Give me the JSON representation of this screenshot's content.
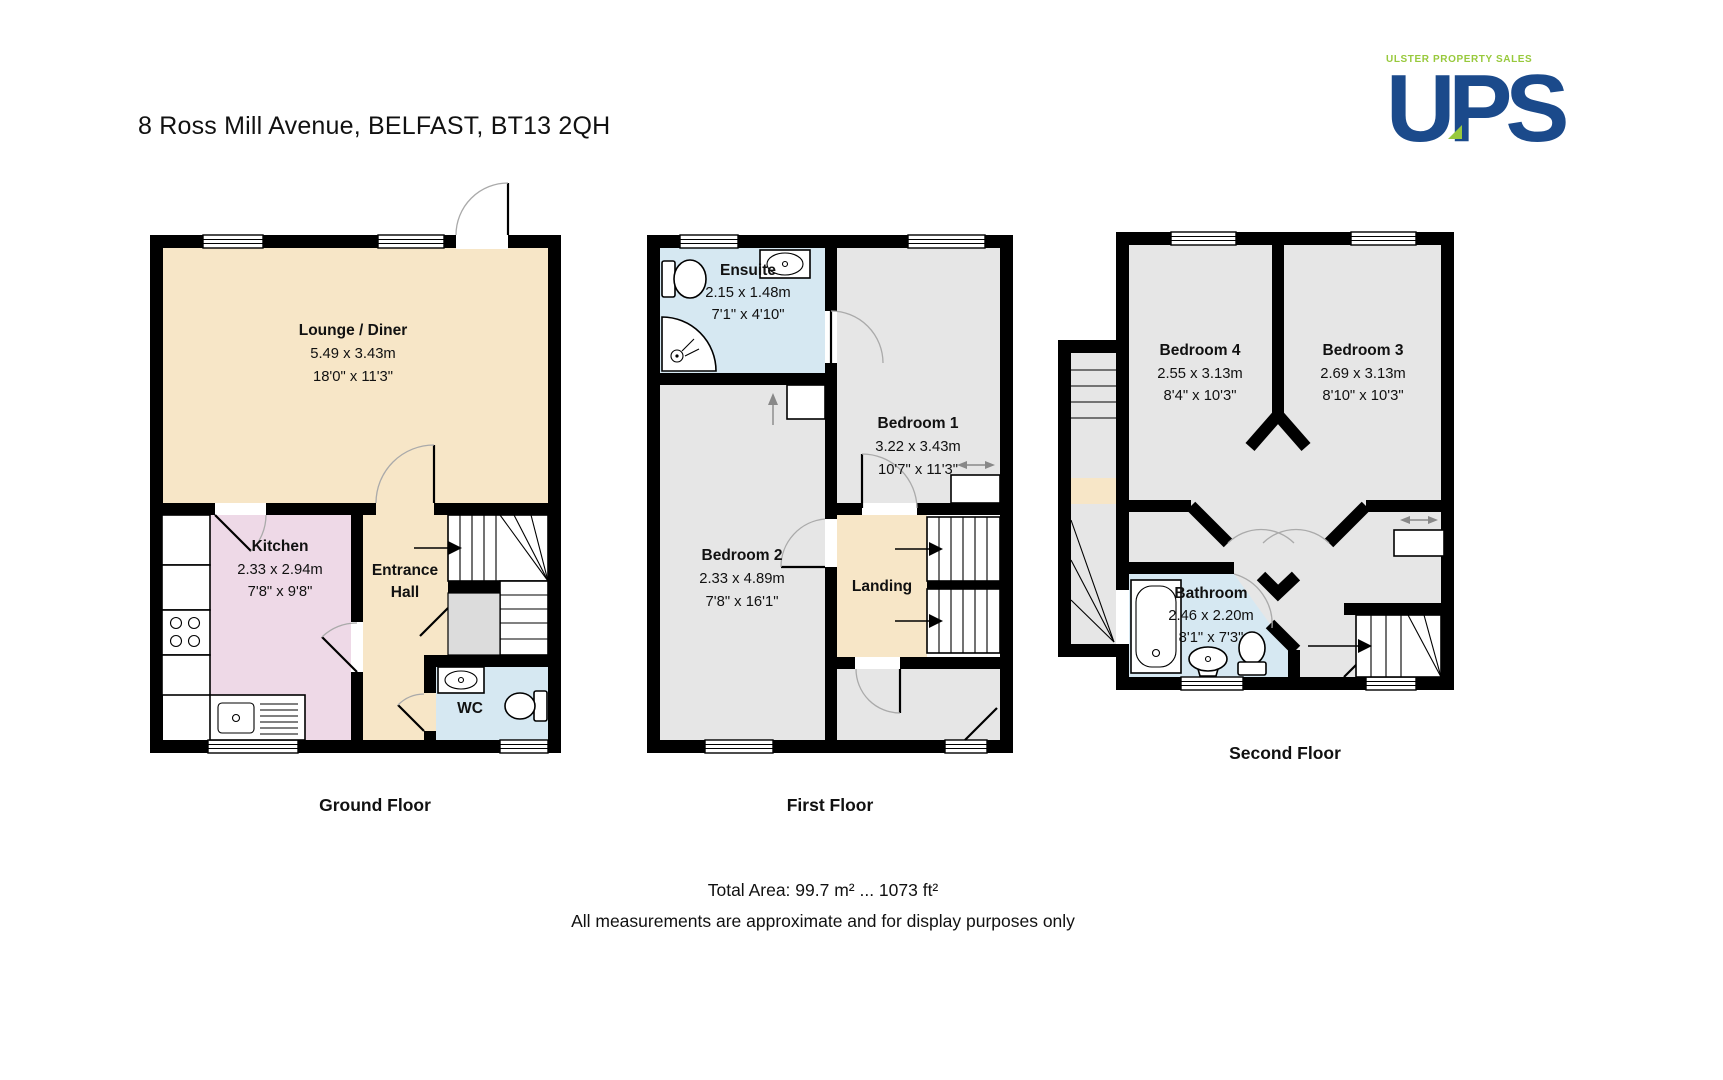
{
  "page": {
    "title": "8 Ross Mill Avenue, BELFAST, BT13 2QH",
    "total_area": "Total Area: 99.7 m² ... 1073 ft²",
    "disclaimer": "All measurements are approximate and for display purposes only"
  },
  "logo": {
    "tagline": "ULSTER PROPERTY SALES",
    "text": "UPS"
  },
  "colors": {
    "wall": "#000000",
    "lounge_hall_landing": "#f7e6c7",
    "kitchen": "#eed9e7",
    "bath_wc": "#d6e8f2",
    "bedroom_gray": "#e6e6e6",
    "cupboard_gray": "#dcdcdc",
    "logo_navy": "#1b4a8b",
    "logo_green": "#98c93c"
  },
  "floors": {
    "ground": {
      "label": "Ground Floor",
      "lounge": {
        "name": "Lounge / Diner",
        "metric": "5.49 x 3.43m",
        "imperial": "18'0\" x 11'3\""
      },
      "kitchen": {
        "name": "Kitchen",
        "metric": "2.33 x 2.94m",
        "imperial": "7'8\" x 9'8\""
      },
      "hall": {
        "line1": "Entrance",
        "line2": "Hall"
      },
      "wc": {
        "name": "WC"
      }
    },
    "first": {
      "label": "First Floor",
      "ensuite": {
        "name": "Ensuite",
        "metric": "2.15 x 1.48m",
        "imperial": "7'1\" x 4'10\""
      },
      "bedroom1": {
        "name": "Bedroom 1",
        "metric": "3.22 x 3.43m",
        "imperial": "10'7\" x 11'3\""
      },
      "bedroom2": {
        "name": "Bedroom 2",
        "metric": "2.33 x 4.89m",
        "imperial": "7'8\" x 16'1\""
      },
      "landing": {
        "name": "Landing"
      }
    },
    "second": {
      "label": "Second Floor",
      "bedroom4": {
        "name": "Bedroom 4",
        "metric": "2.55 x 3.13m",
        "imperial": "8'4\" x 10'3\""
      },
      "bedroom3": {
        "name": "Bedroom 3",
        "metric": "2.69 x 3.13m",
        "imperial": "8'10\" x 10'3\""
      },
      "bathroom": {
        "name": "Bathroom",
        "metric": "2.46 x 2.20m",
        "imperial": "8'1\" x 7'3\""
      }
    }
  }
}
